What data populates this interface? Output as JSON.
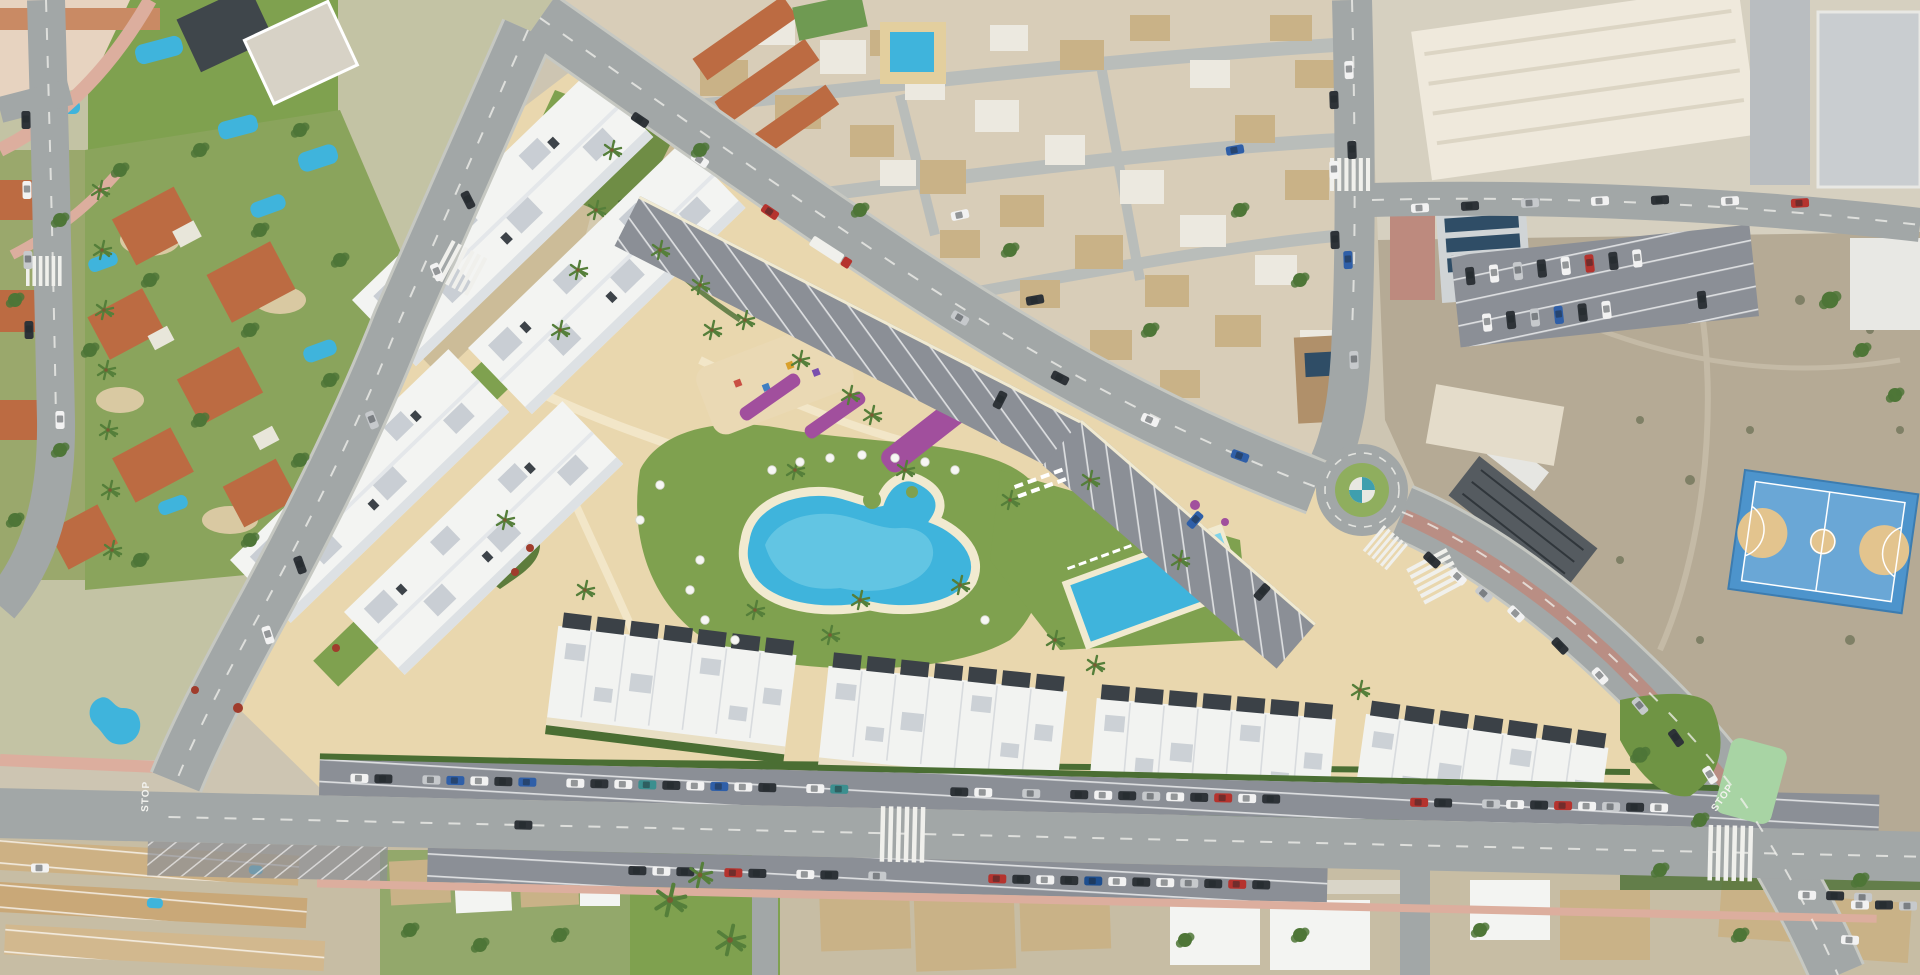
{
  "scene": {
    "title": "Aerial drone view of a coastal residential development with pools, white apartment blocks and surrounding streets",
    "type": "aerial-photograph",
    "time_of_day": "daytime"
  },
  "palette": {
    "base": "#cdc5b2",
    "sand": "#e9d7ae",
    "path_cream": "#f2e6c8",
    "grass": "#7fa14f",
    "lawn_light": "#8fae5e",
    "hedge": "#4a6e33",
    "tree": "#4e7637",
    "palm": "#557f3a",
    "pool_water": "#3fb4dc",
    "pool_shallow": "#7fd4ea",
    "pool_deck": "#f1ead0",
    "road": "#a2a7a7",
    "curb": "#c6c8c2",
    "asphalt": "#8b8f96",
    "line_white": "#f2f2ee",
    "sidewalk_pink": "#dcae9e",
    "brick_red": "#bd8a7e",
    "building_white": "#f3f4f2",
    "roof_gray": "#c9ced4",
    "roof_dark": "#3b4147",
    "roof_orange": "#bc6b42",
    "roof_tan": "#c9b287",
    "wall_white": "#ece9e0",
    "flower_purple": "#a14f9d",
    "shrub_red": "#a03c2c",
    "dirt": "#b5aa95",
    "court_blue": "#4d94cc",
    "court_tan": "#e3c48e",
    "bike_green": "#a8d4a4",
    "car_white": "#f2f2f2",
    "car_dark": "#2e3338",
    "car_silver": "#c6c9cc",
    "car_red": "#b5332e",
    "car_blue": "#2f5fa8"
  },
  "road_markings": {
    "stop_label": "STOP"
  },
  "features": {
    "development": {
      "apartment_blocks": 4,
      "townhouse_rows": 4,
      "lagoon_pool": "free-form lagoon pool with sun lawn and white parasols",
      "lap_pool": "rectangular community pool with sun deck",
      "playground": "children's play area with colourful equipment",
      "flower_beds": "purple bougainvillea planting strips",
      "parking": "angled parking strip along the main avenue and bottom street"
    },
    "surroundings": {
      "roundabout": "roundabout with green centre and teal-white pinwheel",
      "sports_court": "blue multi-sport court on waste ground",
      "old_town": "dense village houses with tan and terracotta roofs",
      "villas": "villas with private pools north-west of the site",
      "industrial": "large white commercial roofs and car parks to the north-east"
    },
    "stop_markings_count": 2
  }
}
